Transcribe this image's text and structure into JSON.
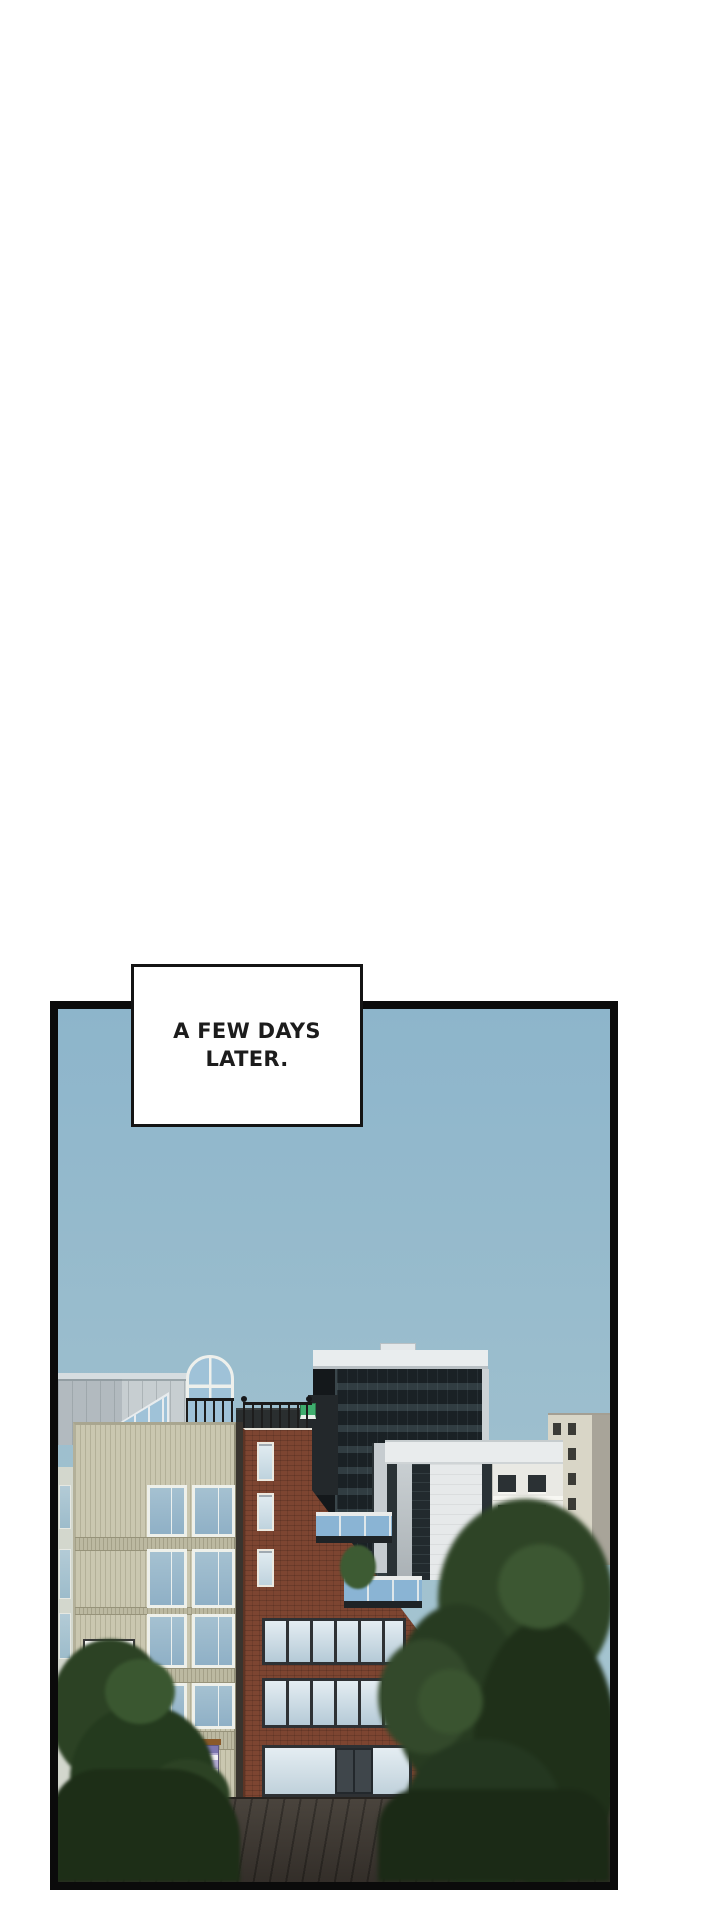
{
  "caption": {
    "lines": [
      "A FEW DAYS",
      "LATER."
    ]
  },
  "panel": {
    "type": "comic-panel",
    "content": "city street scene with office buildings, brick building, trees and empty road under a clear sky"
  },
  "signs": {
    "directory_rows": 6
  },
  "colors": {
    "page_bg": "#ffffff",
    "panel_border": "#0b0b0b",
    "caption_border": "#141414",
    "caption_text": "#1c1c1c",
    "sky_top": "#8db5cb",
    "sky_bottom": "#abc9d3",
    "beige_wall": "#cac7b0",
    "beige_window": "#9fbccd",
    "brick": "#7d4531",
    "dark_tower": "#222a2e",
    "tower_parapet": "#e9edee",
    "white_building": "#e9eced",
    "classical_building": "#e9e9e4",
    "highrise": "#d9d6c7",
    "window_glass": "#cfe0ea",
    "balcony_glass": "#8ab4d4",
    "tree_dark": "#1f3019",
    "tree_light": "#3c5732",
    "road": "#46403a",
    "directory_sign": "#b3abd4",
    "mascot_pink": "#d6336e",
    "mascot_teal": "#3aaca0",
    "green_sign": "#3fae6e"
  }
}
